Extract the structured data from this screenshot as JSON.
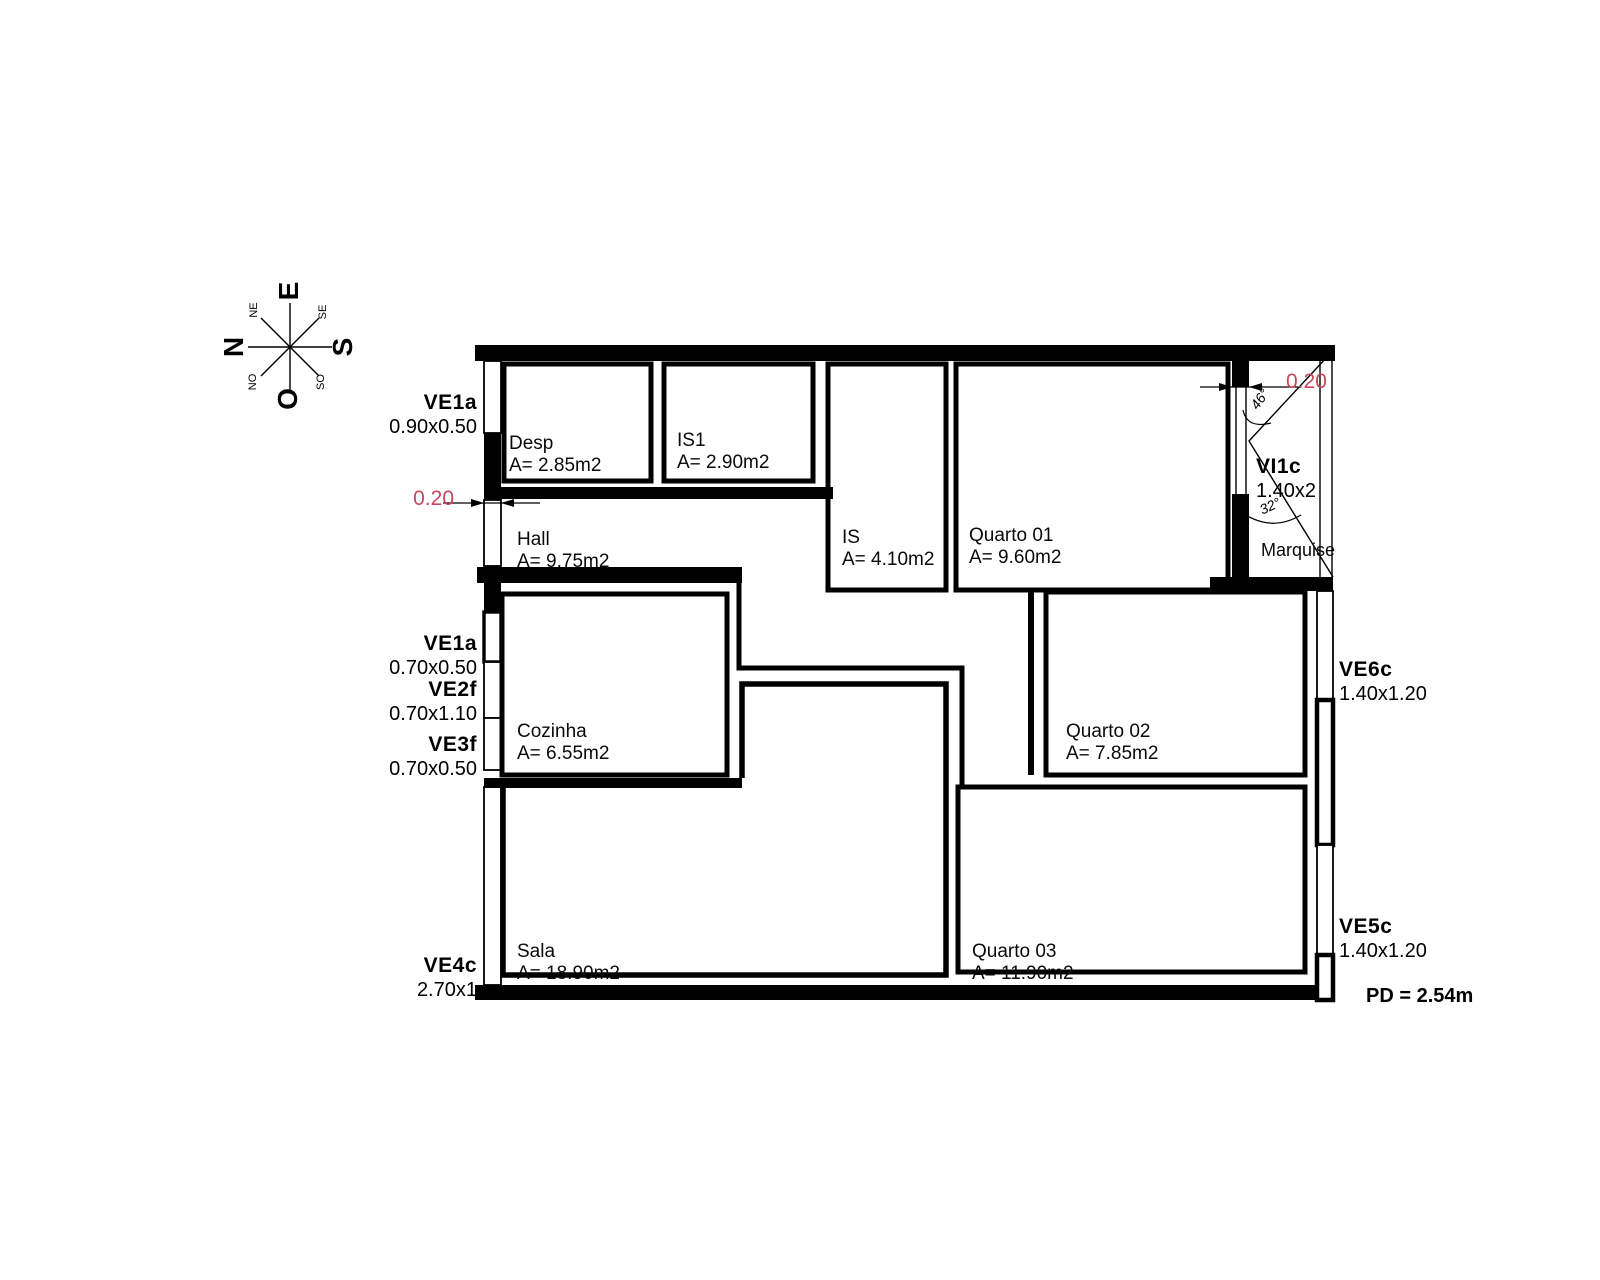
{
  "colors": {
    "ink": "#000000",
    "dim_red": "#c8475c",
    "paper": "#ffffff"
  },
  "compass": {
    "e": "E",
    "n": "N",
    "s": "S",
    "o": "O",
    "ne": "NE",
    "se": "SE",
    "no": "NO",
    "so": "SO"
  },
  "rooms": [
    {
      "name": "Desp",
      "area": "A= 2.85m2"
    },
    {
      "name": "IS1",
      "area": "A= 2.90m2"
    },
    {
      "name": "Hall",
      "area": "A= 9.75m2"
    },
    {
      "name": "IS",
      "area": "A= 4.10m2"
    },
    {
      "name": "Quarto 01",
      "area": "A= 9.60m2"
    },
    {
      "name": "Cozinha",
      "area": "A= 6.55m2"
    },
    {
      "name": "Quarto 02",
      "area": "A= 7.85m2"
    },
    {
      "name": "Sala",
      "area": "A= 18.90m2"
    },
    {
      "name": "Quarto 03",
      "area": "A= 11.90m2"
    },
    {
      "name": "Marquise",
      "area": ""
    }
  ],
  "openings": [
    {
      "code": "VE1a",
      "size": "0.90x0.50"
    },
    {
      "code": "VE1a",
      "size": "0.70x0.50"
    },
    {
      "code": "VE2f",
      "size": "0.70x1.10"
    },
    {
      "code": "VE3f",
      "size": "0.70x0.50"
    },
    {
      "code": "VE4c",
      "size": "2.70x1"
    },
    {
      "code": "VE5c",
      "size": "1.40x1.20"
    },
    {
      "code": "VE6c",
      "size": "1.40x1.20"
    },
    {
      "code": "VI1c",
      "size": "1.40x2"
    }
  ],
  "dimensions": {
    "wall_left": "0.20",
    "wall_right": "0.20",
    "angle_upper": "46°",
    "angle_lower": "32°"
  },
  "notes": {
    "ceiling_height": "PD = 2.54m"
  }
}
